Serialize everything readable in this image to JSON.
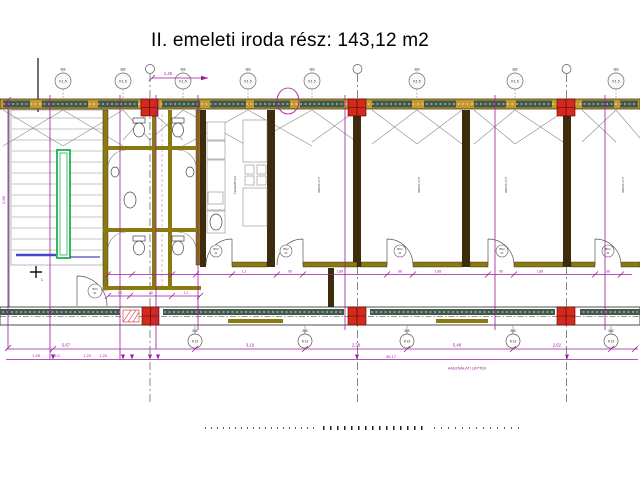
{
  "title": "II. emeleti iroda rész: 143,12 m2",
  "footer_note": "HASZNÁLATI LÉPTÉK",
  "top_dim": "1,45",
  "left_dim": "2,98",
  "total_dim": "36,17",
  "dims_row1": [
    "5,67",
    "3,19",
    "2,38",
    "5,48",
    "2,62"
  ],
  "dims_row2": [
    "1,28",
    "2,0",
    "1,20",
    "1,25"
  ],
  "door_dims": [
    "1,2",
    "68",
    "1,88",
    "68",
    "1,88",
    "68",
    "1,88",
    "68"
  ],
  "wc_dims": [
    "1,2",
    "68",
    "1,2"
  ],
  "window_bubble": {
    "tag": "8|8",
    "label": "K1.5"
  },
  "grid_bubble": {
    "tag": "8|8",
    "label": "K13"
  },
  "door_bubble": {
    "label": "BK2",
    "sub": "21"
  },
  "marker_one": "1",
  "rooms": {
    "kitchen_label": "TEAKONYHA",
    "office_label": "IRODA 17,5"
  },
  "colors": {
    "wall_tan": "#c49a2e",
    "wall_olive": "#8a7a10",
    "wall_brown": "#3d2c0c",
    "window_green": "#41594b",
    "column_red": "#d42a1e",
    "dimension_magenta": "#9c1a9c",
    "rail_green": "#00a63c",
    "stair_blue": "#4747c7",
    "line_gray": "#8a8a8a"
  }
}
